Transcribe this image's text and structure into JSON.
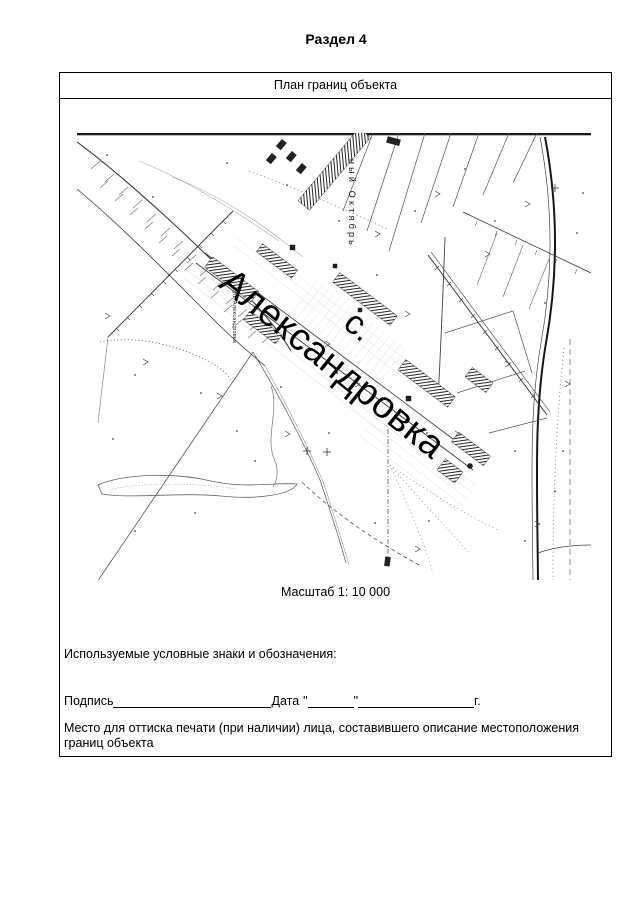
{
  "page": {
    "title": "Раздел 4"
  },
  "panel": {
    "header": "План границ объекта",
    "scale_label": "Масштаб 1: 10 000",
    "legend_label": "Используемые условные знаки и обозначения:",
    "signature": {
      "label": "Подпись",
      "date_label": "Дата",
      "quote_open": "\"",
      "quote_close": "\"",
      "year_suffix": "г."
    },
    "stamp_note": "Место для оттиска печати (при наличии) лица, составившего описание местоположения границ объекта"
  },
  "map": {
    "village_prefix": "с.",
    "village_name": "Александровка",
    "street_label": "ный Октябрь",
    "street_label_small": "ул. Александровка"
  }
}
